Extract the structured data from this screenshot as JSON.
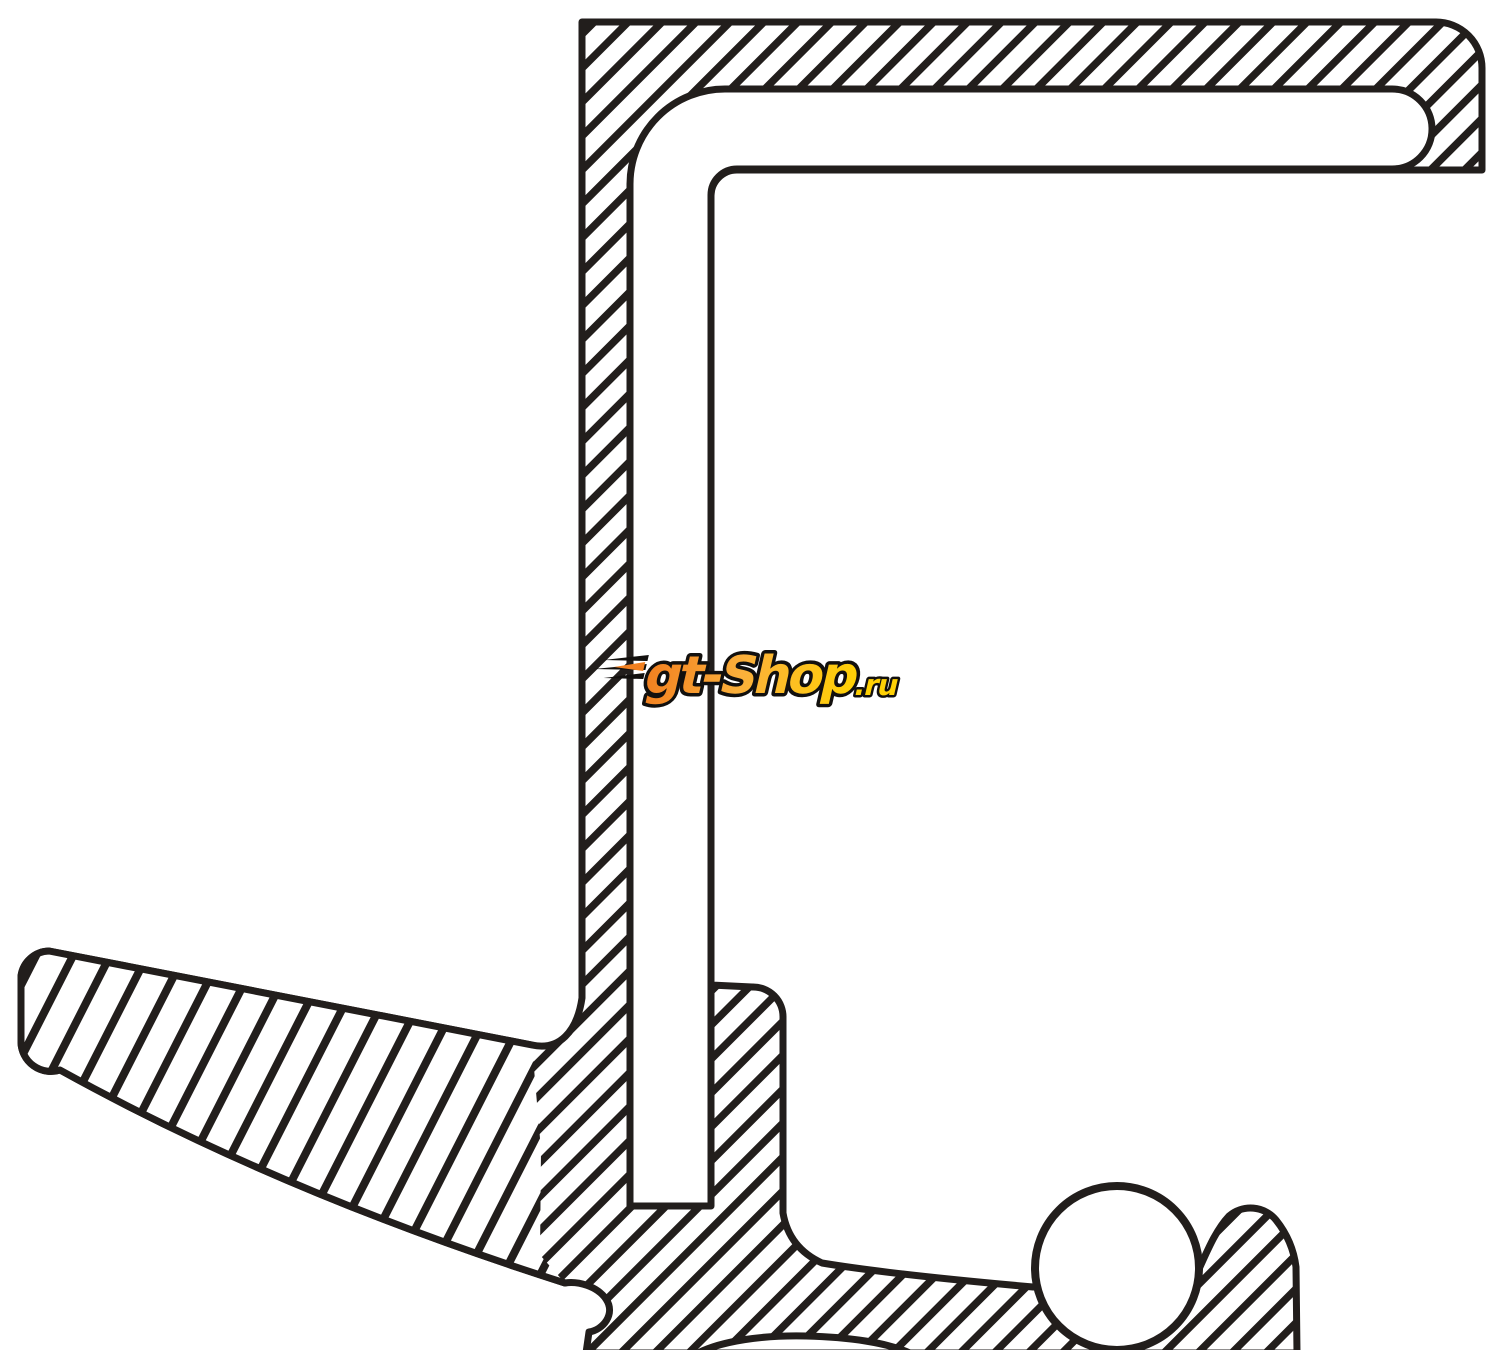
{
  "page": {
    "background_color": "#ffffff",
    "line_color": "#221e1c"
  },
  "watermark": {
    "text_main": "gt-Shop",
    "text_suffix": ".ru",
    "colors": {
      "orange": "#f28020",
      "amber": "#fbb03b",
      "yellow": "#ffd105",
      "outline": "#12100e"
    }
  }
}
